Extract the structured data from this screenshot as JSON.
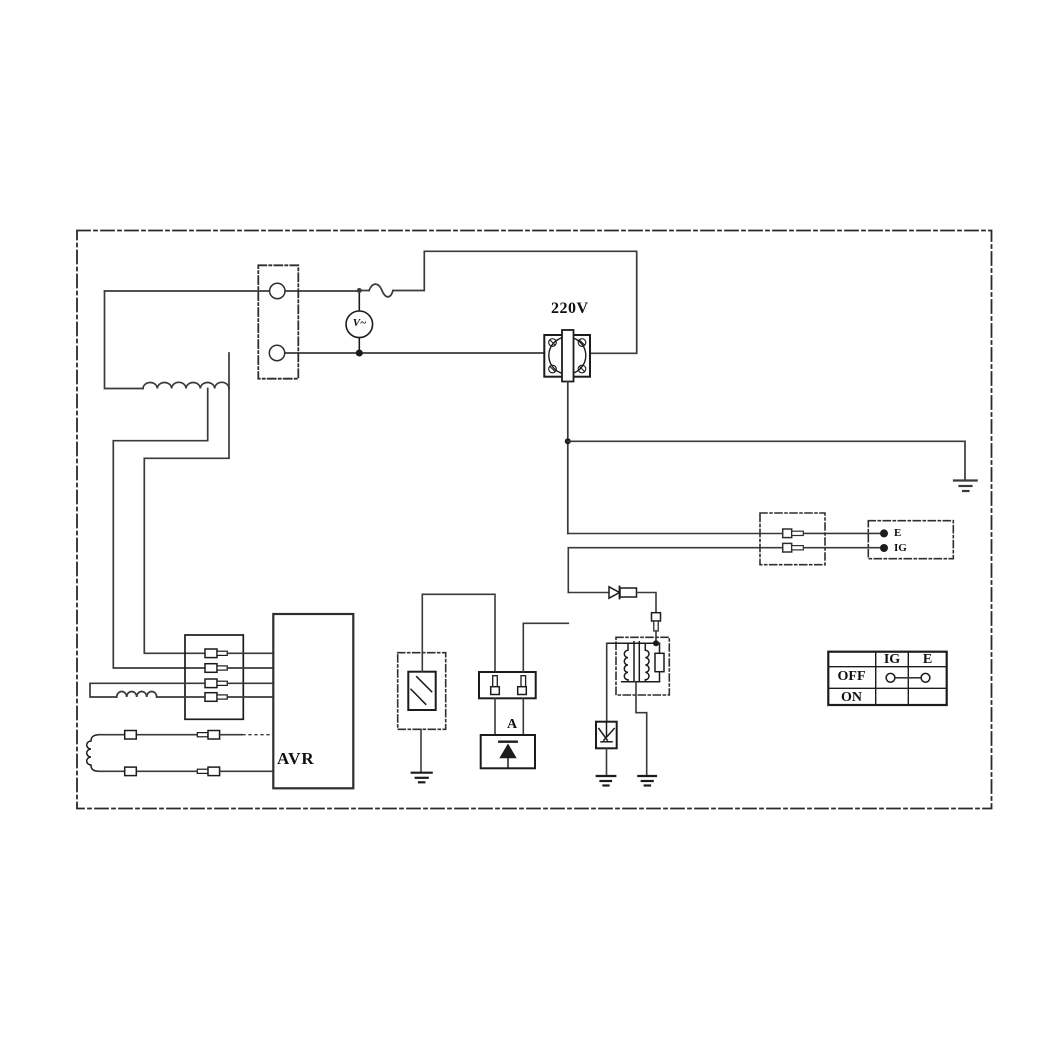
{
  "colors": {
    "background": "#ffffff",
    "line": "#3a3a3a",
    "symbol": "#1c1c1c",
    "text": "#101010"
  },
  "labels": {
    "voltage": "220V",
    "voltmeter": "V~",
    "avr": "AVR",
    "rectifier": "A",
    "terminal_e": "E",
    "terminal_ig": "IG"
  },
  "switch_table": {
    "col_ig": "IG",
    "col_e": "E",
    "row_off": "OFF",
    "row_on": "ON"
  },
  "components": [
    "dashed-boundary",
    "main-winding-coil",
    "two-pole-connector",
    "voltmeter",
    "fuse",
    "receptacle-220v",
    "earth-ground",
    "pin-connector-pair",
    "e-ig-terminal-block",
    "diode",
    "ignition-coil",
    "spark-plug",
    "oil-level-sensor",
    "rectifier-diode-unit",
    "four-pin-connector-block",
    "exciter-winding",
    "charge-winding",
    "avr-unit",
    "engine-switch-table"
  ]
}
